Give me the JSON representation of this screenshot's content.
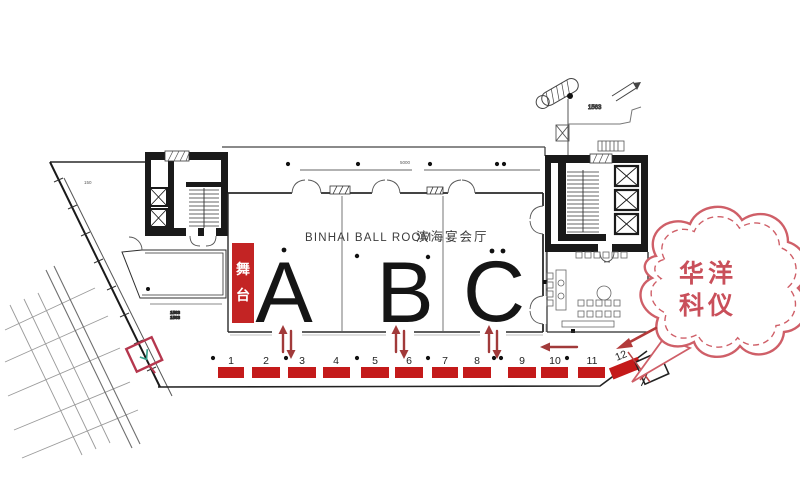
{
  "title": {
    "en": "BINHAI BALL ROOM",
    "zh": "滨海宴会厅"
  },
  "stage": {
    "char1": "舞",
    "char2": "台"
  },
  "sections": [
    "A",
    "B",
    "C"
  ],
  "booths": [
    "1",
    "2",
    "3",
    "4",
    "5",
    "6",
    "7",
    "8",
    "9",
    "10",
    "11",
    "12"
  ],
  "stamp": {
    "line1": "华洋",
    "line2": "科仪"
  },
  "refs": {
    "dim_top": "5000",
    "ref_upper_right": "1563",
    "ref_diagonal": "150",
    "room_ref_a": "1563",
    "room_ref_b": "1563"
  },
  "colors": {
    "booth_red": "#c41a1a",
    "stage_red": "#c32424",
    "arrow_red": "#a13a3a",
    "stamp_pink": "#cf5f68",
    "stamp_text": "#c94f5a",
    "wall_black": "#1a1a1a"
  }
}
